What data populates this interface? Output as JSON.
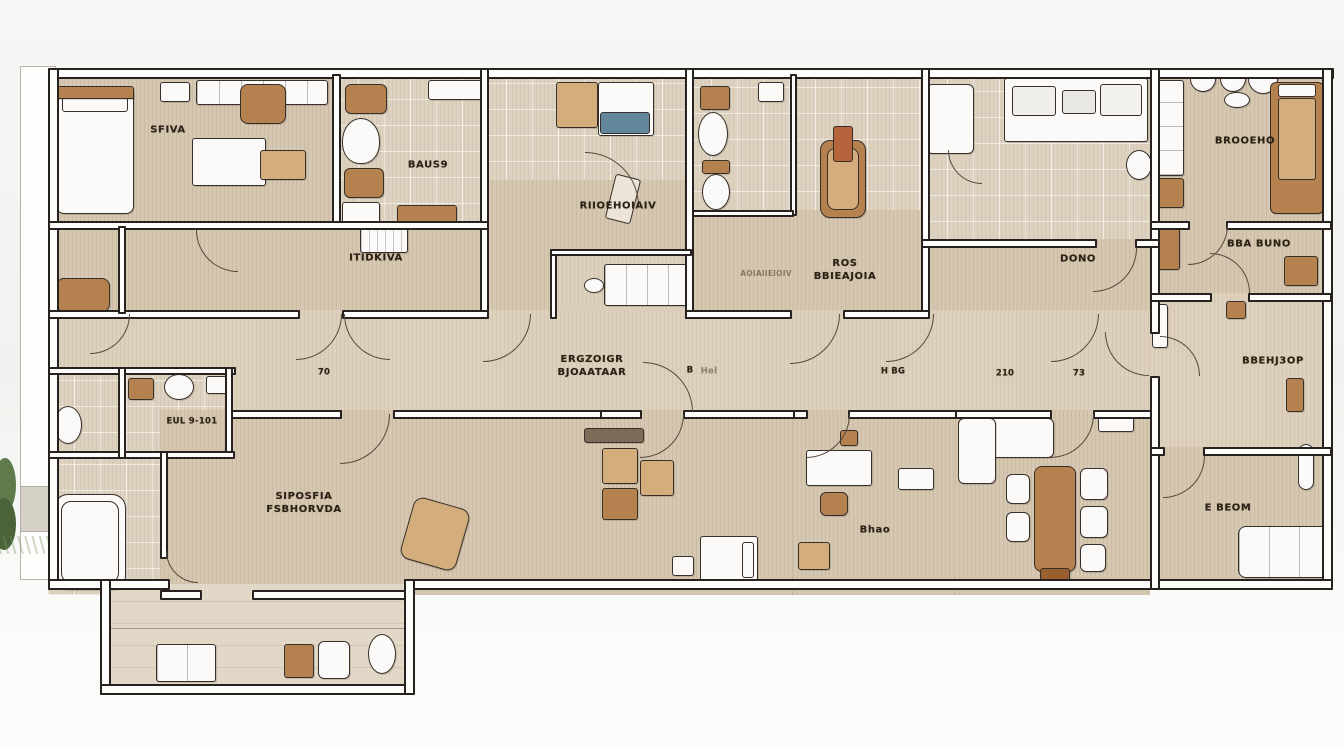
{
  "title": "apartment floor plan sketch",
  "colors": {
    "floor_beige": "#d6c7b1",
    "floor_light": "#ddd0bc",
    "tile": "#ddd2c0",
    "wall_fill": "#fdfdfc",
    "wall_line": "#272220",
    "wood": "#b5814e",
    "wood_dark": "#9a5f2e",
    "wood_light": "#d3ad7c",
    "sink_blue": "#64869c",
    "plant_green": "#5f7b4b",
    "label_ink": "#2a2115"
  },
  "rooms": {
    "sfiva": {
      "label": "SFIVA"
    },
    "baus9": {
      "label": "BAUS9"
    },
    "itidkiva": {
      "label": "ITIDKIVA"
    },
    "rioehoiav": {
      "label": "RIIOEHOIAIV"
    },
    "ros": {
      "label": "ROS",
      "label2": "BBIEAJOIA",
      "note": "AOIAIIEIOIV"
    },
    "dono": {
      "label": "DONO"
    },
    "brooeho": {
      "label": "BROOEHO"
    },
    "bbabuno": {
      "label": "BBA BUNO"
    },
    "bbehj3op": {
      "label": "BBEHJ3OP"
    },
    "corridor": {
      "label": "ERGZOIGR",
      "label2": "BJOAATAAR"
    },
    "eul": {
      "label": "EUL 9-101"
    },
    "siposfia": {
      "label": "SIPOSFIA",
      "label2": "FSBHORVDA"
    },
    "bhao": {
      "label": "Bhao"
    },
    "ebeom": {
      "label": "E BEOM"
    }
  },
  "dimensions": {
    "d70": "70",
    "dB": "B",
    "dHel": "Hel",
    "dHbg": "H BG",
    "d210": "210",
    "d73": "73"
  }
}
